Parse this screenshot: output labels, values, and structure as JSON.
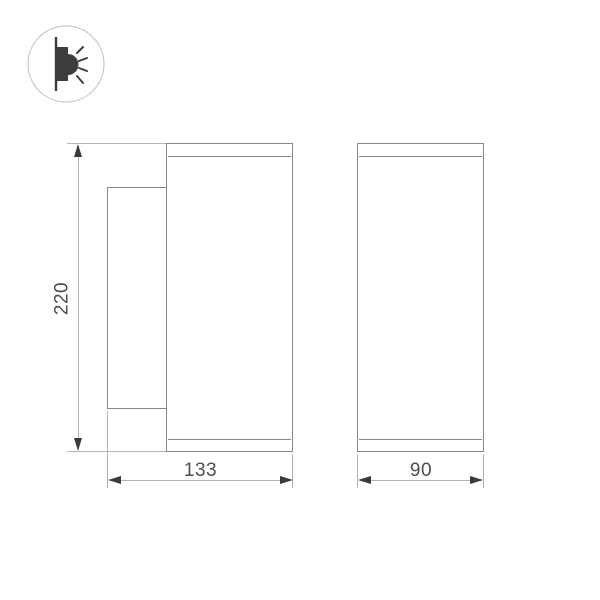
{
  "icon_badge": {
    "name": "wall-lamp-emitting-light",
    "rays_count": 4
  },
  "dimensions": {
    "height_label": "220",
    "side_width_label": "133",
    "front_width_label": "90"
  },
  "colors": {
    "object_line": "#878787",
    "dim_line": "#b4b4b4",
    "arrow": "#3a3a3a",
    "label_text": "#4d4d4d",
    "icon_ink": "#3d3d3d",
    "icon_circle": "#c6c6c6",
    "canvas_bg": "#ffffff"
  }
}
